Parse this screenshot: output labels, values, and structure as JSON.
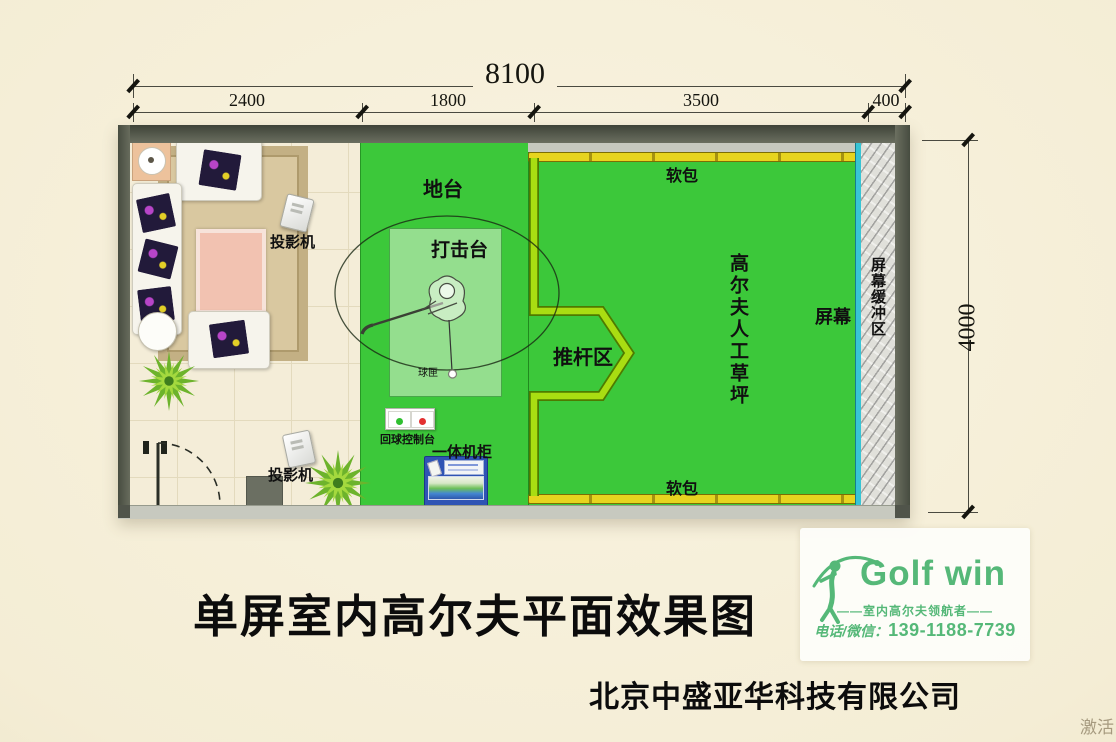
{
  "dimensions": {
    "total_width": "8100",
    "segments": [
      "2400",
      "1800",
      "3500",
      "400"
    ],
    "height": "4000"
  },
  "plan": {
    "labels": {
      "platform": "地台",
      "hitting_station": "打击台",
      "putting_zone": "推杆区",
      "artificial_turf": "高尔夫人工草坪",
      "soft_padding_top": "软包",
      "soft_padding_bottom": "软包",
      "screen": "屏幕",
      "screen_buffer": "屏幕缓冲区",
      "projector_top": "投影机",
      "projector_bottom": "投影机",
      "ball_box": "球匣",
      "ball_return_console": "回球控制台",
      "all_in_one_cabinet": "一体机柜"
    },
    "colors": {
      "turf_green": "#3cc83a",
      "mat_green": "#94de8e",
      "putting_border_lime": "#a9dd12",
      "soft_padding_yellow": "#e7d41f",
      "screen_cyan": "#38c4d4",
      "wall_gray": "#545a4e"
    }
  },
  "footer": {
    "title": "单屏室内高尔夫平面效果图",
    "company": "北京中盛亚华科技有限公司"
  },
  "logo": {
    "brand": "Golf win",
    "tagline": "——室内高尔夫领航者——",
    "phone_label": "电话/微信：",
    "phone_number": "139-1188-7739",
    "brand_color": "#55b878"
  },
  "watermark": "激活"
}
